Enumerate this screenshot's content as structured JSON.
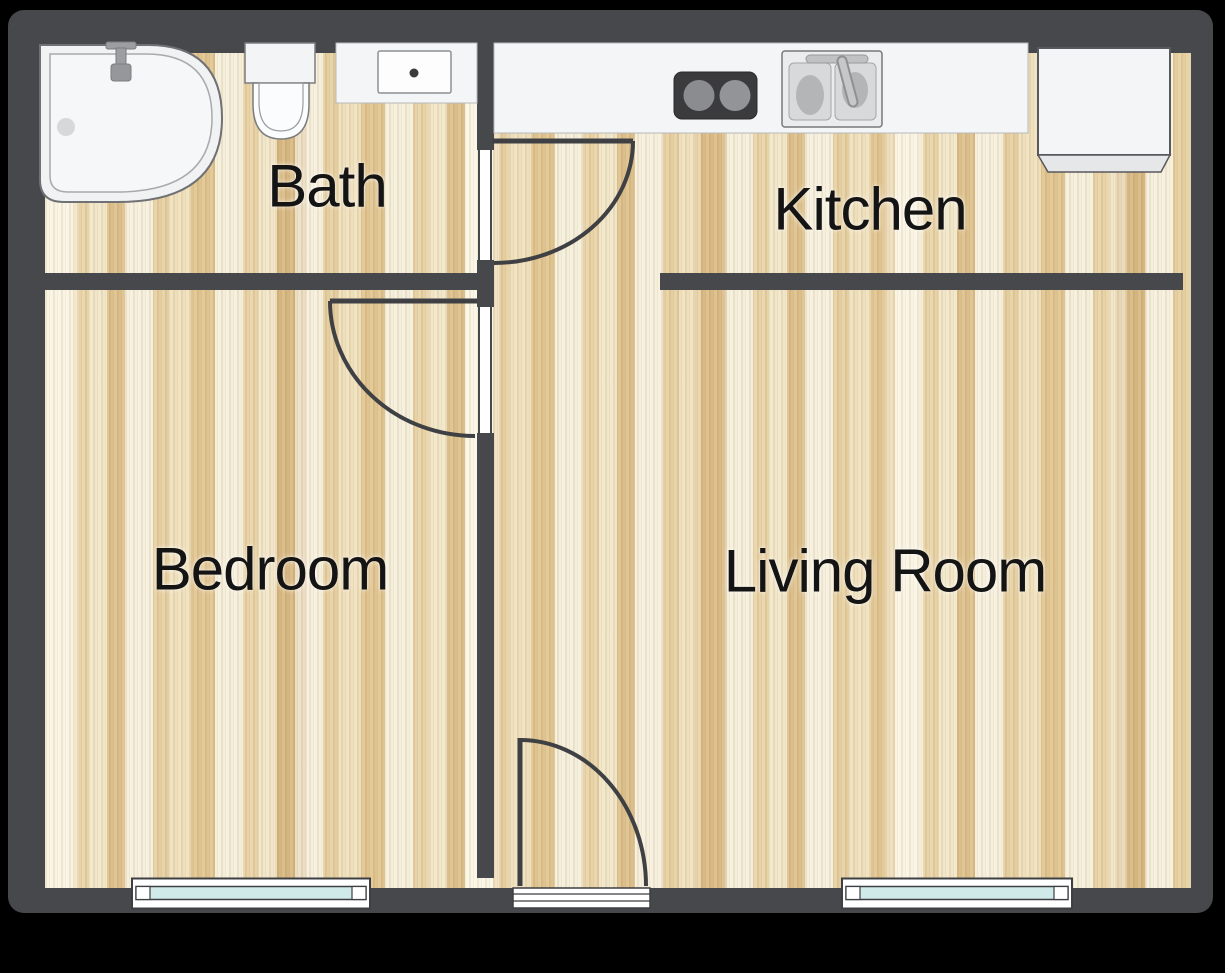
{
  "rooms": {
    "bath": {
      "label": "Bath"
    },
    "kitchen": {
      "label": "Kitchen"
    },
    "bedroom": {
      "label": "Bedroom"
    },
    "living_room": {
      "label": "Living Room"
    }
  },
  "fixtures": {
    "bath": [
      "bathtub",
      "toilet",
      "vanity-sink"
    ],
    "kitchen": [
      "stove-cooktop",
      "double-sink",
      "refrigerator"
    ]
  },
  "openings": {
    "doors": [
      "bath-door",
      "bedroom-door",
      "entry-door"
    ],
    "windows": [
      "bedroom-window",
      "living-room-window"
    ]
  },
  "colors": {
    "background": "#000000",
    "wall": "#47484b",
    "floor_base": "#ecd9b0",
    "floor_light": "#f5eeda",
    "floor_dark": "#dcc08b",
    "fixture_fill": "#f4f5f7",
    "stove": "#3b3b3d",
    "window_glass": "#cfeae8",
    "label_text": "#141414"
  }
}
